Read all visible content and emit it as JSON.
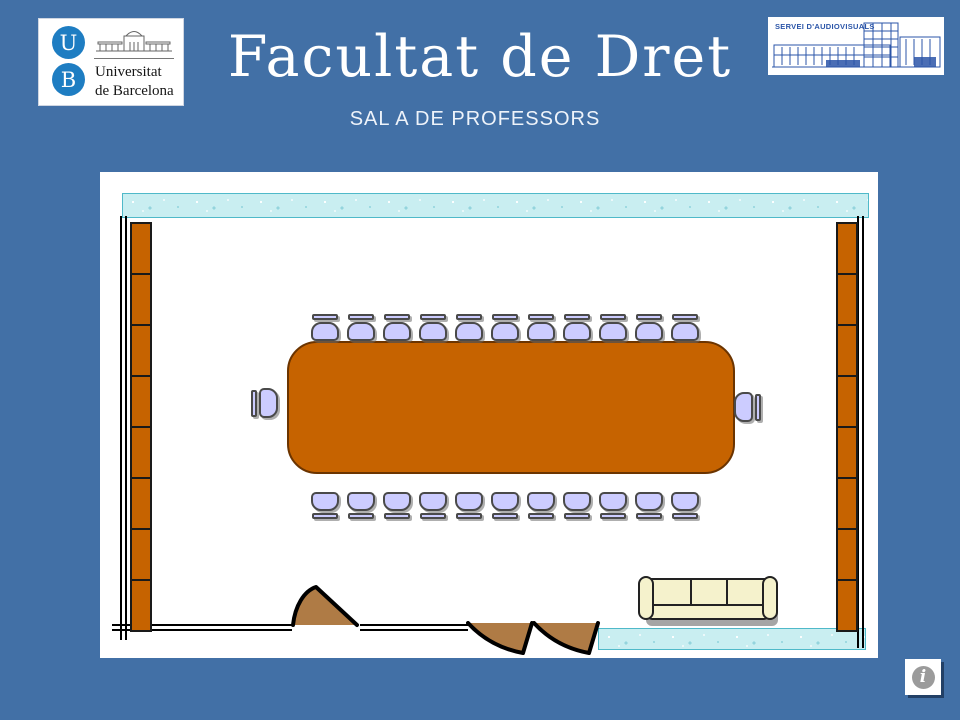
{
  "slide": {
    "title": "Facultat de Dret",
    "subtitle": "SAL A DE PROFESSORS"
  },
  "ub_logo": {
    "letter_top": "U",
    "letter_bottom": "B",
    "name_line1": "Universitat",
    "name_line2": "de Barcelona"
  },
  "av_logo": {
    "label": "SERVEI D'AUDIOVISUALS"
  },
  "colors": {
    "bg": "#4270A6",
    "ub-blue": "#1E7DC2",
    "av-ink": "#2B55A8",
    "wall": "#000000",
    "band": "#C9EEF1",
    "band-border": "#4FB9C9",
    "shelf": "#C66300",
    "shelf-border": "#1A1A1A",
    "table": "#C66300",
    "table-border": "#6B3400",
    "chair": "#CCCCFF",
    "chair-border": "#4A4A4A",
    "sofa": "#F5F2CC",
    "sofa-border": "#222222",
    "door": "#AF7B45"
  },
  "floorplan": {
    "counts": {
      "chairs_top": 11,
      "chairs_bottom": 11,
      "end_chairs": 2,
      "shelf_segments_left": 8,
      "shelf_segments_right": 8,
      "sofa_cushions": 3,
      "single_doors": 1,
      "double_door_leaves": 2
    }
  },
  "info_button": {
    "glyph": "i"
  }
}
